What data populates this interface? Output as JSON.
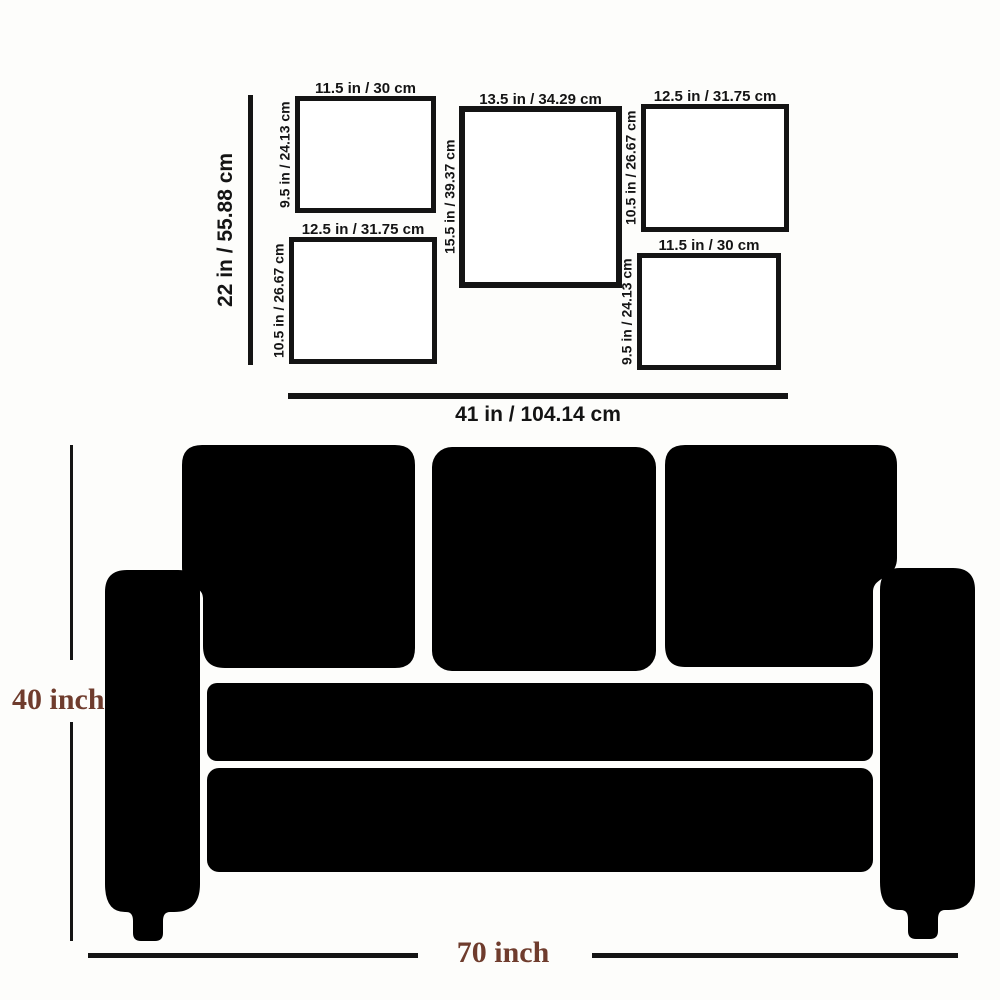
{
  "diagram": {
    "wall_height_label": "22 in / 55.88 cm",
    "wall_width_label": "41 in / 104.14 cm",
    "frames": [
      {
        "position": "top-left",
        "width_label": "11.5 in / 30 cm",
        "height_label": "9.5 in / 24.13 cm"
      },
      {
        "position": "center",
        "width_label": "13.5 in / 34.29 cm",
        "height_label": "15.5 in / 39.37 cm"
      },
      {
        "position": "top-right",
        "width_label": "12.5 in / 31.75 cm",
        "height_label": "10.5 in / 26.67 cm"
      },
      {
        "position": "bottom-left",
        "width_label": "12.5 in / 31.75 cm",
        "height_label": "10.5 in / 26.67 cm"
      },
      {
        "position": "bottom-right",
        "width_label": "11.5 in / 30 cm",
        "height_label": "9.5 in / 24.13 cm"
      }
    ],
    "line_color": "#141414"
  },
  "sofa": {
    "height_label": "40 inch",
    "width_label": "70 inch",
    "silhouette_color": "#000000",
    "dimension_text_color": "#6f3c2d"
  }
}
